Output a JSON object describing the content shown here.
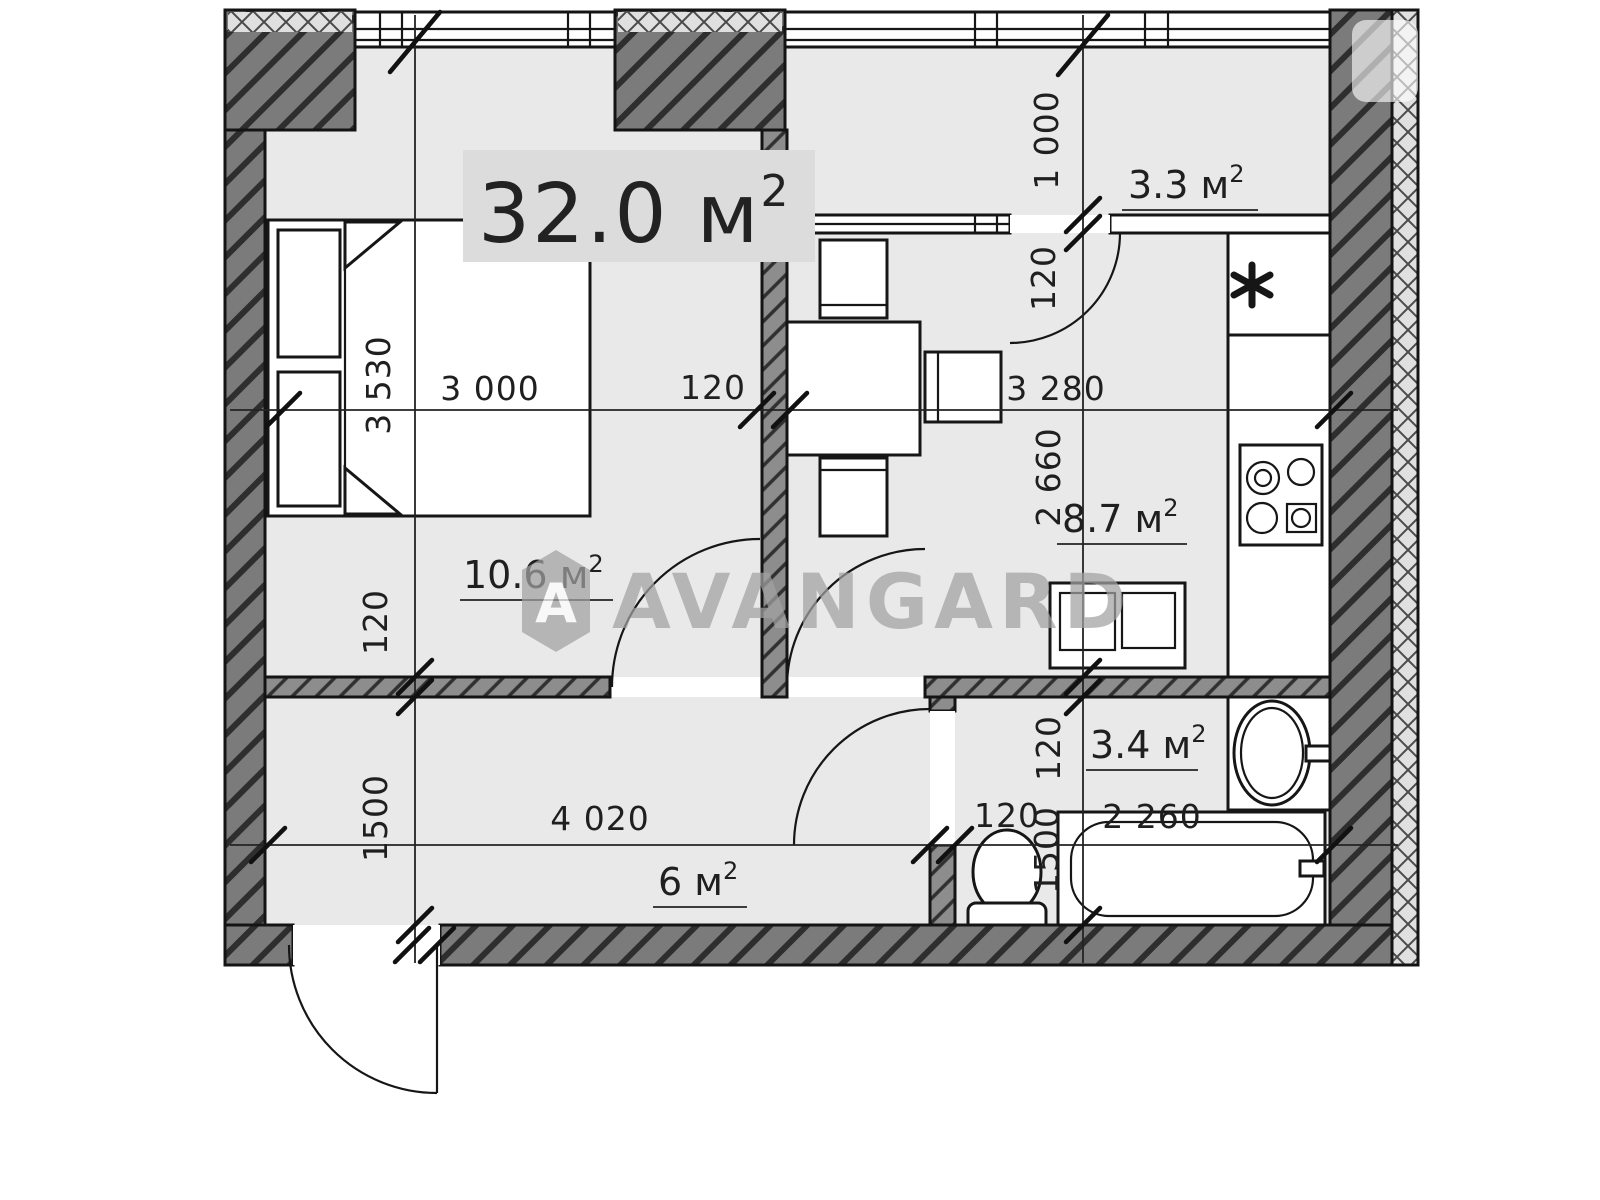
{
  "plan": {
    "title_area": {
      "value": "32.0 м",
      "sup": "2"
    },
    "rooms": [
      {
        "id": "bedroom",
        "area": "10.6 м",
        "sup": "2"
      },
      {
        "id": "kitchen",
        "area": "8.7 м",
        "sup": "2"
      },
      {
        "id": "loggia",
        "area": "3.3 м",
        "sup": "2"
      },
      {
        "id": "bathroom",
        "area": "3.4 м",
        "sup": "2"
      },
      {
        "id": "hallway",
        "area": "6 м",
        "sup": "2"
      }
    ],
    "dims": {
      "bedroom_w": "3 000",
      "wall_bedroom_kitchen": "120",
      "kitchen_w": "3 280",
      "bedroom_h": "3 530",
      "wall_bedroom_hall": "120",
      "hall_h": "1500",
      "loggia_d": "1 000",
      "loggia_partition": "120",
      "kitchen_d": "2 660",
      "wall_kitchen_bath": "120",
      "bath_h": "1500",
      "hall_w": "4 020",
      "wall_hall_bath": "120",
      "tub_w": "2 260"
    },
    "watermark": {
      "brand": "AVANGARD",
      "logo": "A"
    },
    "colors": {
      "floor": "#e9e9e9",
      "wall_fill": "#7b7b7b",
      "line": "#161616",
      "watermark": "#a2a2a2",
      "title_badge": "#dcdcdc"
    },
    "fixtures": [
      "bed",
      "pillows",
      "dining-table",
      "chairs",
      "vent-shaft",
      "cooktop",
      "kitchen-sink-cabinet",
      "wash-basin",
      "bathtub",
      "toilet"
    ]
  }
}
